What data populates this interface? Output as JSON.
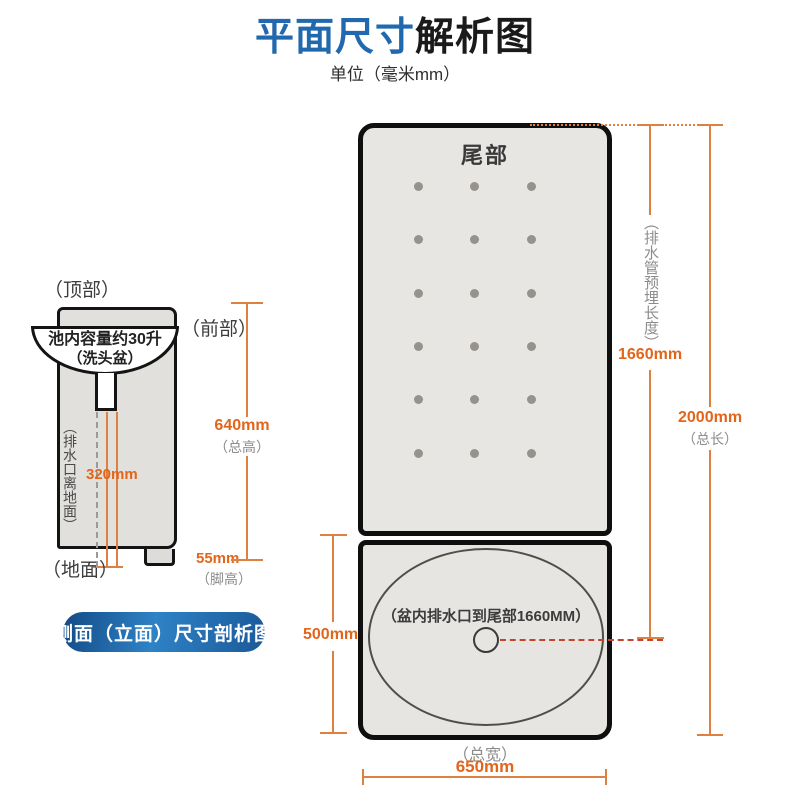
{
  "title": {
    "highlight": "平面尺寸",
    "rest": "解析图",
    "subtitle": "单位（毫米mm）"
  },
  "side_view": {
    "top_label": "（顶部）",
    "front_label": "（前部）",
    "ground_label": "（地面）",
    "basin_capacity_line1": "池内容量约30升",
    "basin_capacity_line2": "（洗头盆）",
    "drain_height_label": "（排水口离地面）",
    "drain_height_value": "320mm",
    "total_height_value": "640mm",
    "total_height_label": "（总高）",
    "foot_height_value": "55mm",
    "foot_height_label": "（脚高）",
    "badge_label": "侧面（立面）尺寸剖析图"
  },
  "plan_view": {
    "tail_label": "尾部",
    "vent_dots": {
      "rows": 6,
      "cols": 3
    },
    "basin_note": "（盆内排水口到尾部1660MM）",
    "pipe_length_label": "（排水管预埋长度）",
    "pipe_length_value": "1660mm",
    "total_length_value": "2000mm",
    "total_length_label": "（总长）",
    "basin_section_value": "500mm",
    "total_width_label": "（总宽）",
    "total_width_value": "650mm"
  },
  "colors": {
    "title_blue": "#2268ae",
    "dimension_orange": "#e2651a",
    "dimension_line": "#dd8040",
    "drain_red_dash": "#c4432c",
    "badge_blue_dark": "#134a85",
    "badge_blue_light": "#2e82c6",
    "panel_gray": "#e8e6e3",
    "outline_black": "#0f0f0f"
  }
}
